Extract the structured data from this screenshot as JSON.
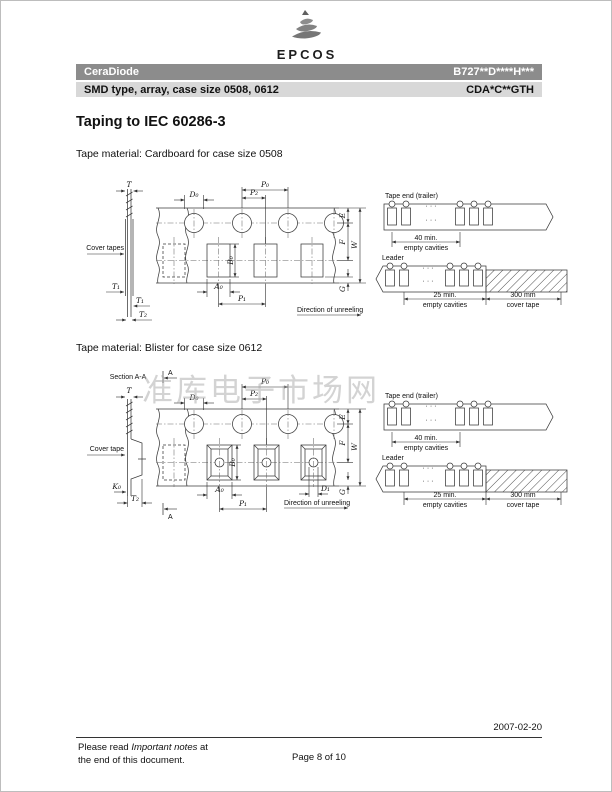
{
  "header": {
    "logo": "EPCOS",
    "product_line": "CeraDiode",
    "part_number": "B727**D****H***",
    "subtitle": "SMD type, array, case size 0508, 0612",
    "ordering_code": "CDA*C**GTH",
    "bar_dark": "#8c8c8c",
    "bar_light": "#d8d8d8"
  },
  "content": {
    "title": "Taping to IEC 60286-3",
    "caption_cardboard": "Tape material: Cardboard for case size 0508",
    "caption_blister": "Tape material: Blister for case size 0612"
  },
  "dims": {
    "T": "T",
    "T1": "T₁",
    "T2": "T₂",
    "D0": "D₀",
    "D1": "D₁",
    "P0": "P₀",
    "P1": "P₁",
    "P2": "P₂",
    "A0": "A₀",
    "B0": "B₀",
    "K0": "K₀",
    "E": "E",
    "F": "F",
    "W": "W",
    "G": "G"
  },
  "labels": {
    "cover_tapes": "Cover tapes",
    "cover_tape": "Cover tape",
    "direction": "Direction of unreeling",
    "section": "Section A-A",
    "section_letter": "A",
    "trailer_title": "Tape end (trailer)",
    "trailer_qty": "40 min.",
    "empty_cavities": "empty cavities",
    "leader_title": "Leader",
    "leader_qty": "25 min.",
    "cover_len": "300 mm",
    "cover_tape_dim": "cover tape",
    "dots": "· · ·"
  },
  "watermark": "准库电子市场网",
  "footer": {
    "date": "2007-02-20",
    "note_pre": "Please read ",
    "note_em": "Important notes",
    "note_post": " at",
    "note_line2": "the end of this document.",
    "page_info": "Page 8 of 10"
  }
}
